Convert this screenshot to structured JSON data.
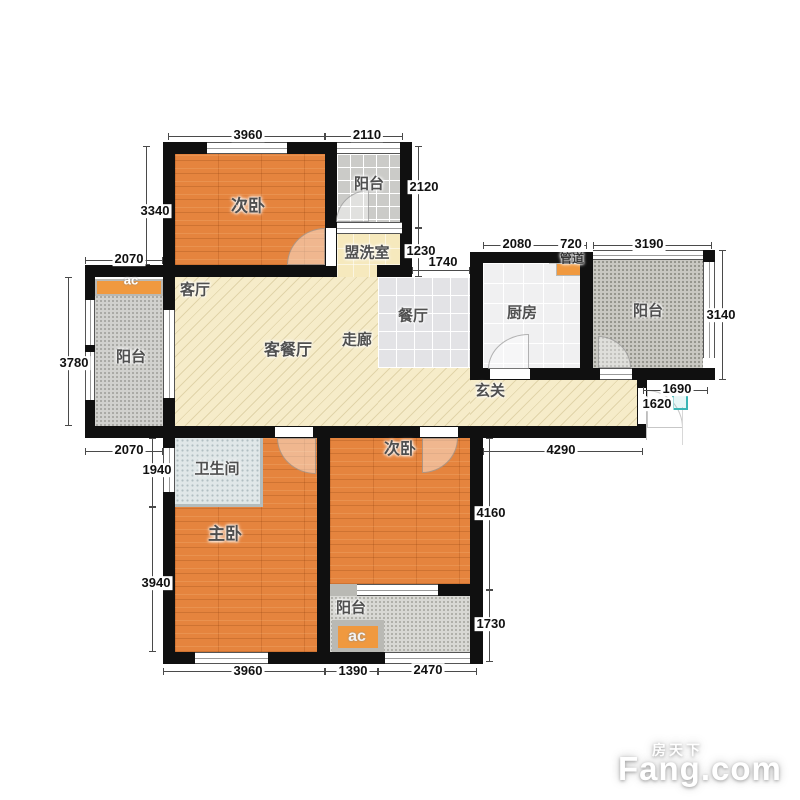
{
  "plan": {
    "rooms": {
      "bed2_top": "次卧",
      "balcony_top": "阳台",
      "washroom": "盟洗室",
      "living": "客厅",
      "living_dining": "客餐厅",
      "corridor": "走廊",
      "dining": "餐厅",
      "kitchen": "厨房",
      "duct": "管道",
      "balcony_right": "阳台",
      "entry": "玄关",
      "balcony_left": "阳台",
      "bathroom": "卫生间",
      "master": "主卧",
      "bed2_bottom": "次卧",
      "balcony_bottom": "阳台",
      "ac_top": "ac",
      "ac_bottom": "ac"
    },
    "dims": {
      "bed2_top_w": "3960",
      "balcony_top_w": "2110",
      "bed2_top_h": "3340",
      "balcony_top_h": "2120",
      "washroom_h": "1230",
      "dining_open_w": "1740",
      "left_top_w": "2070",
      "balcony_left_h": "3780",
      "left_bottom_w": "2070",
      "kitchen_w": "2080",
      "duct_w": "720",
      "balcony_right_w": "3190",
      "balcony_right_h": "3140",
      "entry_w": "1690",
      "entry_h": "1620",
      "hall_w": "4290",
      "bathroom_h": "1940",
      "master_h": "3940",
      "bed2_bottom_h": "4160",
      "balcony_bottom_h": "1730",
      "master_w": "3960",
      "ac_bay_w": "1390",
      "balcony_bottom_w": "2470"
    },
    "colors": {
      "wall": "#101010",
      "wood_floor": "#e5843e",
      "living_floor": "#f6ecc9",
      "ac_unit": "#f0993f",
      "entry_marker": "#3ab5b5"
    }
  },
  "watermark": {
    "brand_cn": "房天下",
    "brand_en": "Fang.com"
  }
}
